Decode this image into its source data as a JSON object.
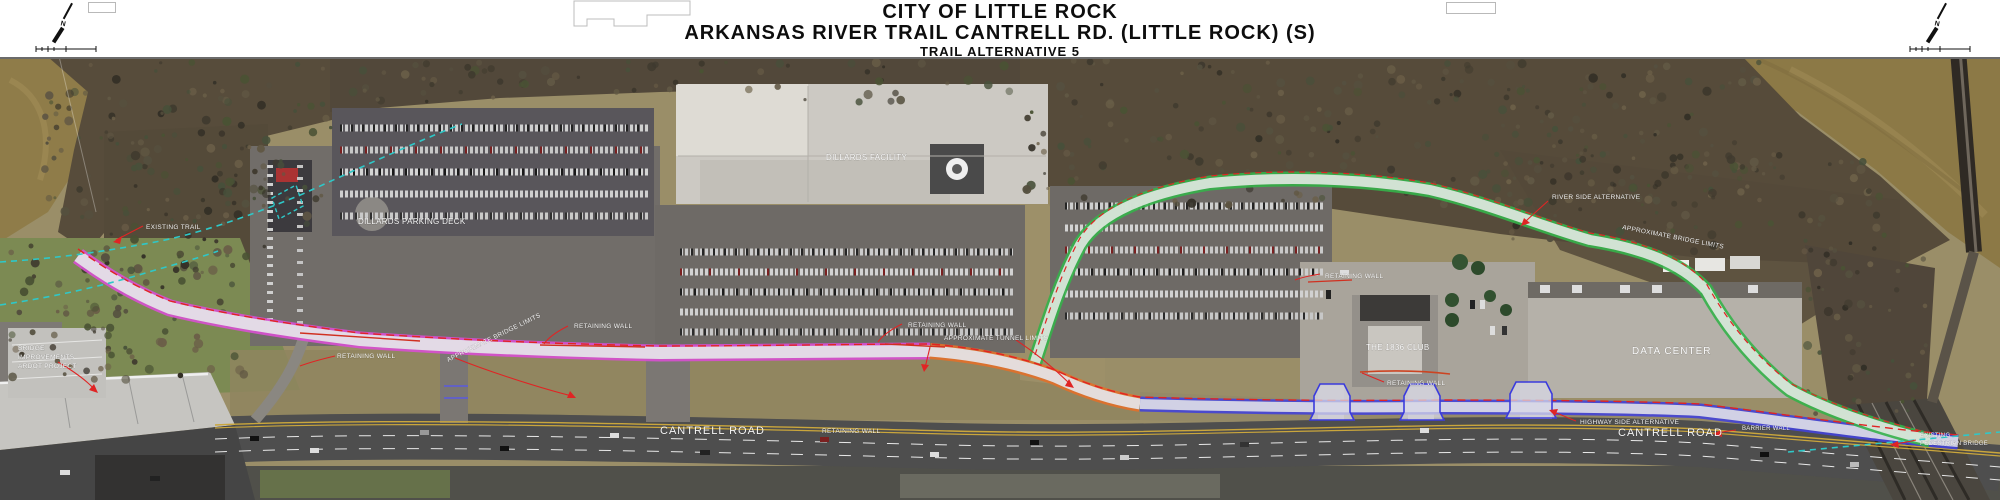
{
  "header": {
    "title_line1": "CITY OF LITTLE ROCK",
    "title_line2": "ARKANSAS RIVER TRAIL CANTRELL RD. (LITTLE ROCK) (S)",
    "title_line3": "TRAIL ALTERNATIVE 5",
    "north_label": "N"
  },
  "map": {
    "labels": {
      "existing_trail": "EXISTING TRAIL",
      "bridge_improvements_lines": [
        "BRIDGE",
        "IMPROVEMENTS",
        "ARDOT PROJECT"
      ],
      "dillards_parking_deck": "DILLARDS PARKING DECK",
      "dillards_facility": "DILLARDS FACILITY",
      "retaining_wall": "RETAINING WALL",
      "approximate_bridge_limits": "APPROXIMATE BRIDGE LIMITS",
      "approximate_tunnel_limits": "APPROXIMATE TUNNEL LIMITS",
      "club_1836": "THE 1836 CLUB",
      "data_center": "DATA CENTER",
      "river_side_alternative": "RIVER SIDE ALTERNATIVE",
      "highway_side_alternative": "HIGHWAY SIDE ALTERNATIVE",
      "cantrell_road": "CANTRELL ROAD",
      "barrier_wall": "BARRIER WALL",
      "existing_pedestrian_bridge_lines": [
        "EXISTING",
        "PEDESTRIAN BRIDGE"
      ]
    },
    "legend_colors": {
      "proposed_trail_edge_magenta": "#d84fd2",
      "road_side_trail_edge_blue": "#4343d8",
      "river_side_trail_edge_green": "#35b24a",
      "tunnel_section_edge_orange": "#e2702a",
      "alignment_red": "#e02424",
      "existing_trail_cyan": "#2ec8c8"
    }
  }
}
